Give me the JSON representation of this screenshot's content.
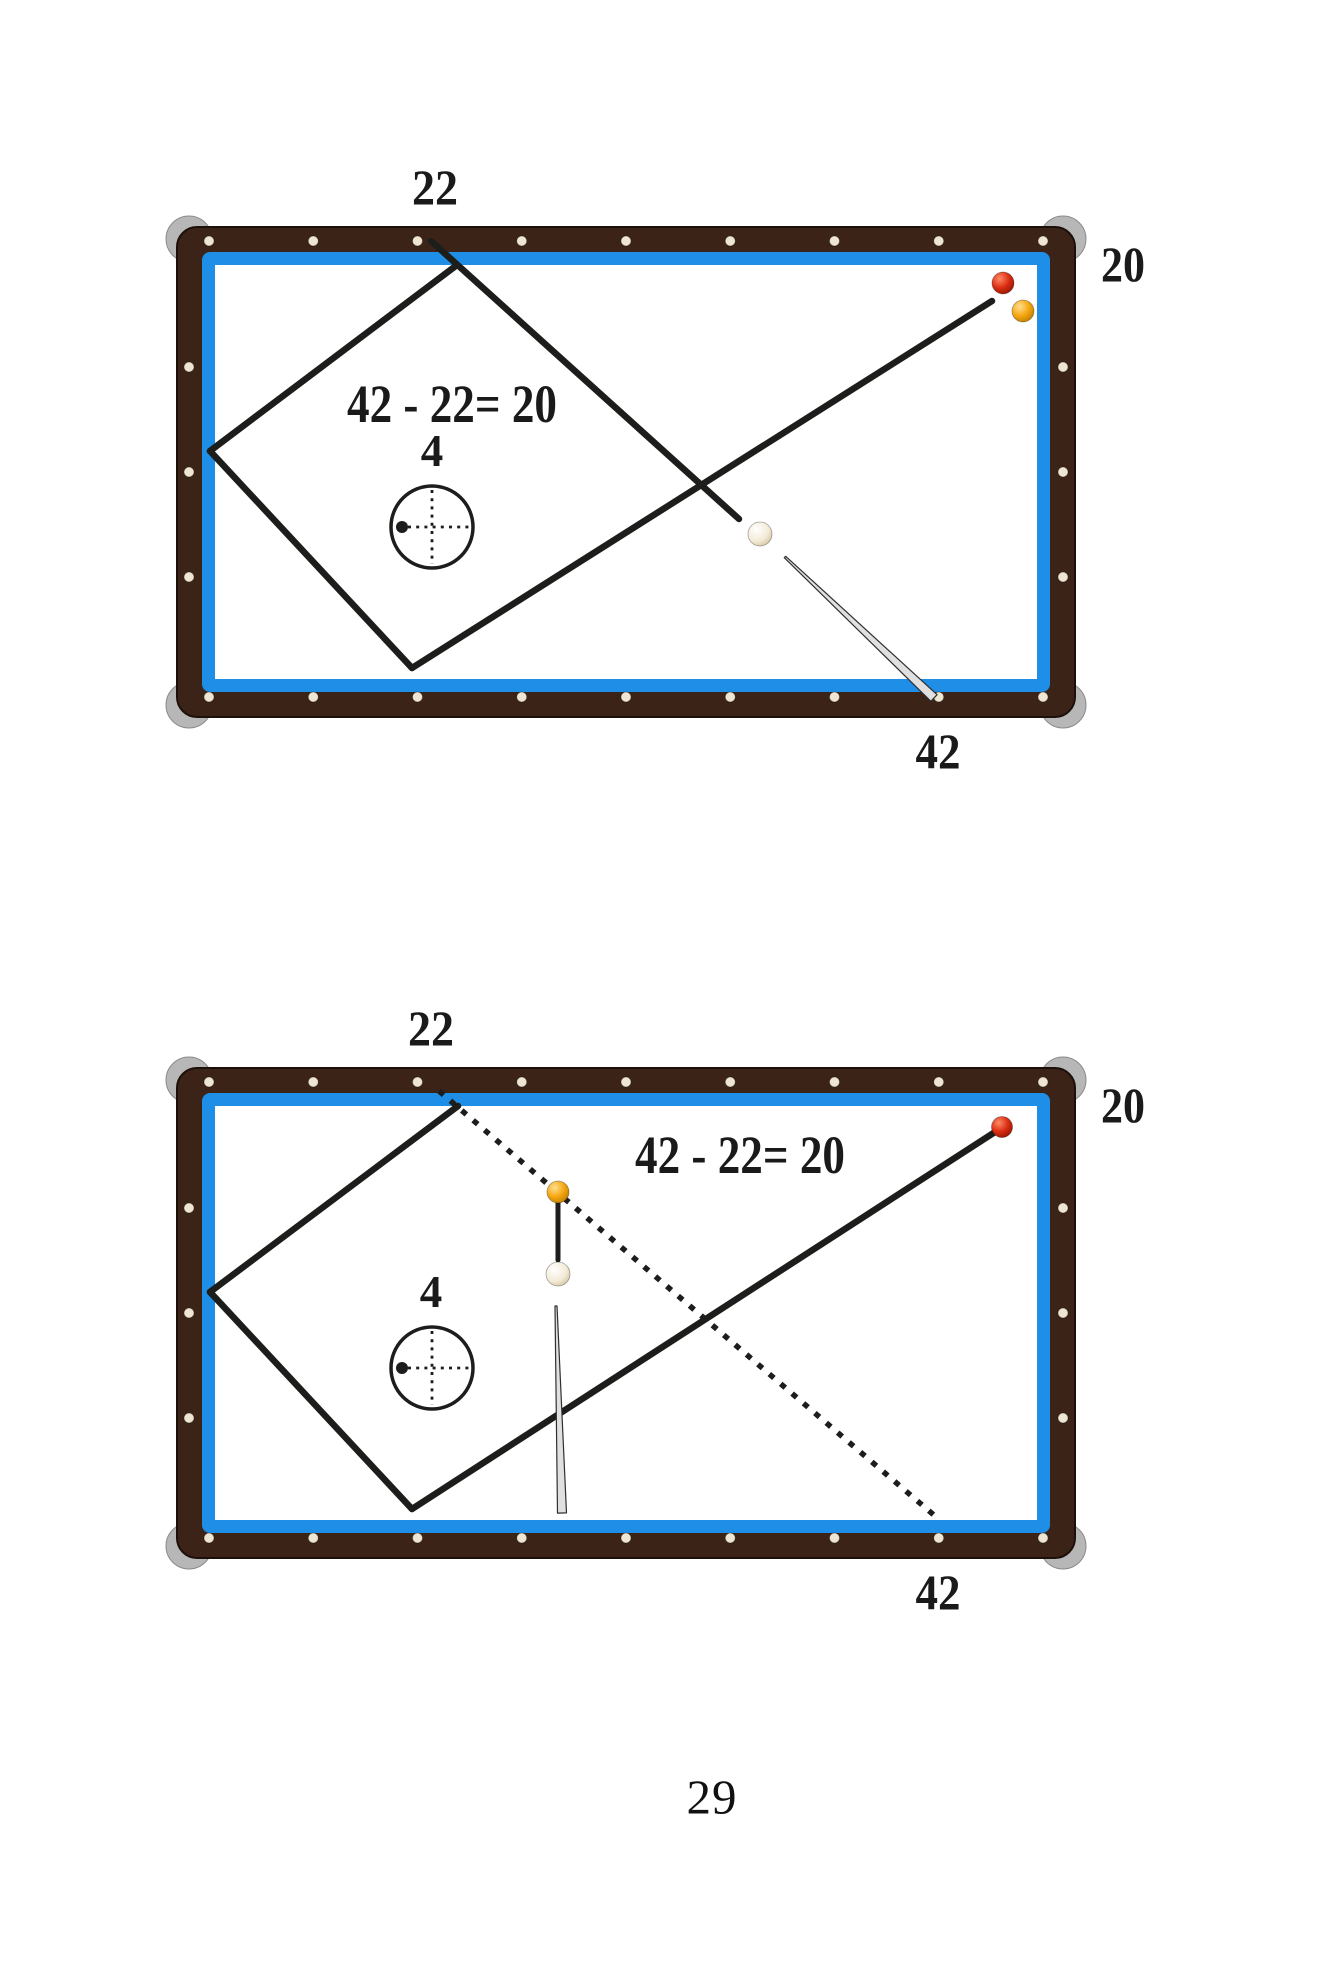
{
  "page": {
    "number": "29",
    "background": "#ffffff"
  },
  "colors": {
    "rail_wood": "#3B2318",
    "rail_edge": "#1d100a",
    "cushion_blue": "#1E8EE6",
    "felt_white": "#ffffff",
    "corner_cap": "#b7b7b7",
    "corner_cap_edge": "#8a8a8a",
    "rail_dot": "#efe6d2",
    "line_black": "#1d1d1b",
    "text_black": "#1a1a1a",
    "stick_fill": "#e0e0e0",
    "stick_edge": "#2f2f2f"
  },
  "table_style": {
    "rail_thickness": 25,
    "cushion_thickness": 13,
    "corner_radius": 20,
    "dot_radius": 5,
    "long_rail_dots": 9,
    "short_rail_dots": 3,
    "dotted_dash": "6 9",
    "crosshair_dash": "3 5.2"
  },
  "diagrams": [
    {
      "name": "diagram-first-shot",
      "frame": {
        "x": 177,
        "y": 227,
        "w": 898,
        "h": 490
      },
      "labels": [
        {
          "id": "rail-number-22",
          "text": "22",
          "x": 435,
          "y": 187,
          "size": 50,
          "tl": 46,
          "bold": true
        },
        {
          "id": "rail-number-20",
          "text": "20",
          "x": 1123,
          "y": 264,
          "size": 50,
          "tl": 44,
          "bold": true
        },
        {
          "id": "rail-number-42",
          "text": "42",
          "x": 938,
          "y": 751,
          "size": 50,
          "tl": 45,
          "bold": true
        },
        {
          "id": "formula",
          "text": "42 - 22= 20",
          "x": 452,
          "y": 404,
          "size": 54,
          "tl": 210,
          "bold": true
        },
        {
          "id": "tip-offset-4",
          "text": "4",
          "x": 432,
          "y": 451,
          "size": 45,
          "bold": true
        }
      ],
      "lines": [
        {
          "id": "aim-line-to-22",
          "style": "solid",
          "x1": 431,
          "y1": 241,
          "x2": 739,
          "y2": 519,
          "w": 6.5
        },
        {
          "id": "diamond-upper-left-edge",
          "style": "solid",
          "x1": 457,
          "y1": 265,
          "x2": 210,
          "y2": 451,
          "w": 6.5
        },
        {
          "id": "diamond-lower-left-edge",
          "style": "solid",
          "x1": 210,
          "y1": 451,
          "x2": 412,
          "y2": 668,
          "w": 6.5
        },
        {
          "id": "return-line-42-to-red",
          "style": "solid",
          "x1": 412,
          "y1": 668,
          "x2": 992,
          "y2": 301,
          "w": 6.5
        },
        {
          "id": "cue-stick",
          "style": "stick",
          "x1": 785,
          "y1": 557,
          "x2": 934,
          "y2": 698,
          "w1": 1,
          "w2": 4.5
        }
      ],
      "balls": [
        {
          "id": "red-ball",
          "color": "red",
          "x": 1003,
          "y": 283,
          "r": 11
        },
        {
          "id": "yellow-ball",
          "color": "yellow",
          "x": 1023,
          "y": 311,
          "r": 11
        },
        {
          "id": "cue-ball",
          "color": "white",
          "x": 760,
          "y": 534,
          "r": 12
        }
      ],
      "aim_indicator": {
        "cx": 432,
        "cy": 527,
        "r": 41,
        "dot_x": 402,
        "dot_y": 527,
        "dot_r": 6
      }
    },
    {
      "name": "diagram-second-shot",
      "frame": {
        "x": 177,
        "y": 1068,
        "w": 898,
        "h": 490
      },
      "labels": [
        {
          "id": "rail-number-22",
          "text": "22",
          "x": 431,
          "y": 1028,
          "size": 50,
          "tl": 46,
          "bold": true
        },
        {
          "id": "rail-number-20",
          "text": "20",
          "x": 1123,
          "y": 1105,
          "size": 50,
          "tl": 44,
          "bold": true
        },
        {
          "id": "rail-number-42",
          "text": "42",
          "x": 938,
          "y": 1592,
          "size": 50,
          "tl": 45,
          "bold": true
        },
        {
          "id": "formula",
          "text": "42 - 22= 20",
          "x": 740,
          "y": 1155,
          "size": 54,
          "tl": 210,
          "bold": true
        },
        {
          "id": "tip-offset-4",
          "text": "4",
          "x": 431,
          "y": 1292,
          "size": 45,
          "bold": true
        }
      ],
      "lines": [
        {
          "id": "aim-line-dotted-to-42",
          "style": "dotted",
          "x1": 439,
          "y1": 1091,
          "x2": 935,
          "y2": 1516,
          "w": 5.5
        },
        {
          "id": "diamond-upper-left-edge",
          "style": "solid",
          "x1": 458,
          "y1": 1106,
          "x2": 210,
          "y2": 1292,
          "w": 6.5
        },
        {
          "id": "diamond-lower-left-edge",
          "style": "solid",
          "x1": 210,
          "y1": 1292,
          "x2": 412,
          "y2": 1509,
          "w": 6.5
        },
        {
          "id": "return-line-42-to-red",
          "style": "solid",
          "x1": 412,
          "y1": 1509,
          "x2": 995,
          "y2": 1132,
          "w": 6.5
        },
        {
          "id": "yellow-to-cue-connector",
          "style": "solid",
          "x1": 558,
          "y1": 1202,
          "x2": 558,
          "y2": 1260,
          "w": 5
        },
        {
          "id": "cue-stick",
          "style": "stick",
          "x1": 556,
          "y1": 1306,
          "x2": 562,
          "y2": 1513,
          "w1": 1,
          "w2": 4.5
        }
      ],
      "balls": [
        {
          "id": "red-ball",
          "color": "red",
          "x": 1002,
          "y": 1127,
          "r": 10.5
        },
        {
          "id": "yellow-ball",
          "color": "yellow",
          "x": 558,
          "y": 1192,
          "r": 11
        },
        {
          "id": "cue-ball",
          "color": "white",
          "x": 558,
          "y": 1274,
          "r": 12
        }
      ],
      "aim_indicator": {
        "cx": 432,
        "cy": 1368,
        "r": 41,
        "dot_x": 402,
        "dot_y": 1368,
        "dot_r": 6
      }
    }
  ]
}
